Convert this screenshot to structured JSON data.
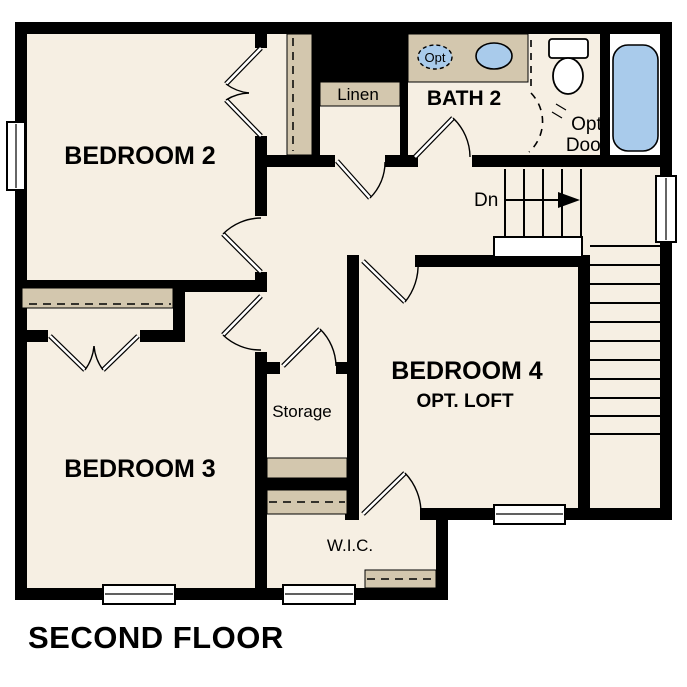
{
  "title": "SECOND FLOOR",
  "colors": {
    "wall": "#000000",
    "floor": "#f6efe3",
    "cabinet": "#d3c7ae",
    "fixture": "#a9cbeb",
    "background": "#ffffff"
  },
  "rooms": {
    "bedroom2": "BEDROOM 2",
    "bedroom3": "BEDROOM 3",
    "bedroom4": "BEDROOM 4",
    "bedroom4_sub": "OPT. LOFT",
    "bath2": "BATH 2",
    "linen": "Linen",
    "storage": "Storage",
    "wic": "W.I.C."
  },
  "labels": {
    "down": "Dn",
    "opt_door_line1": "Opt.",
    "opt_door_line2": "Door",
    "opt_sink": "Opt"
  }
}
